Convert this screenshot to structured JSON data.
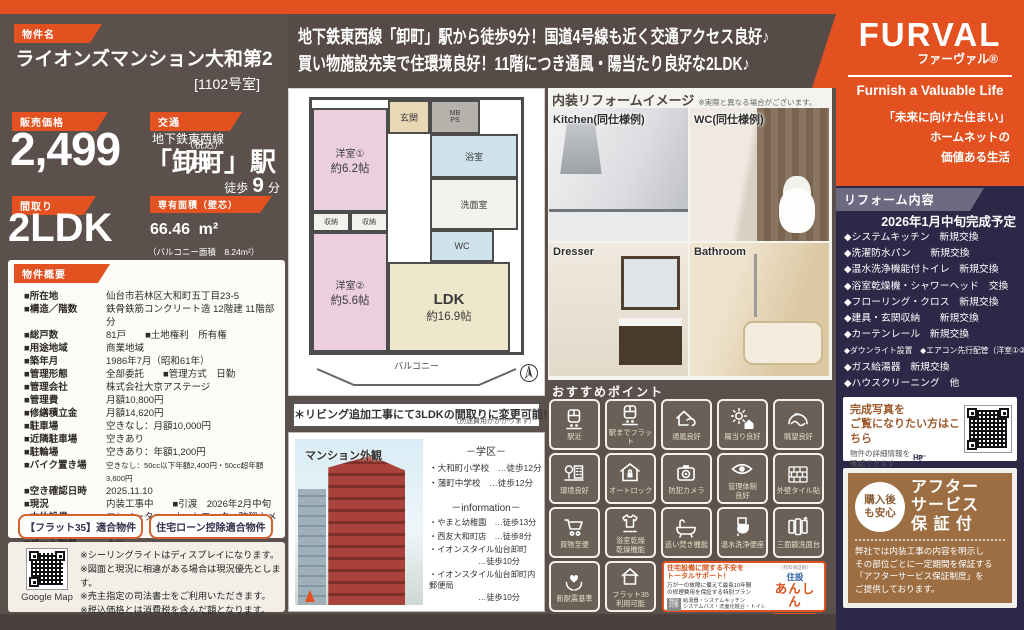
{
  "header": {
    "property_label": "物件名",
    "property_name": "ライオンズマンション大和第2",
    "room_no": "[1102号室]",
    "catch_line1": "地下鉄東西線「卸町」駅から徒歩9分！国道4号線も近く交通アクセス良好♪",
    "catch_line2": "買い物施設充実で住環境良好！11階につき通風・陽当たり良好な2LDK♪"
  },
  "brand": {
    "logo": "FURVAL",
    "logo_kana": "ファーヴァル®",
    "tagline": "Furnish a Valuable Life",
    "slogan": "「未来に向けた住まい」\nホームネットの\n価値ある生活"
  },
  "summary": {
    "price_label": "販売価格",
    "price_value": "2,499",
    "price_tax": "（税込）",
    "price_unit": "万円",
    "access_label": "交通",
    "access_line": "地下鉄東西線",
    "access_station": "「卸町」駅",
    "walk_label": "徒歩",
    "walk_min": "9",
    "walk_unit": "分",
    "layout_label": "間取り",
    "layout_value": "2LDK",
    "area_label": "専有面積（壁芯）",
    "area_value": "66.46",
    "area_unit": "m²",
    "area_note": "（バルコニー面積　8.24m²）"
  },
  "overview": {
    "title": "物件概要",
    "rows": [
      {
        "label": "■所在地",
        "value": "仙台市若林区大和町五丁目23-5"
      },
      {
        "label": "■構造／階数",
        "value": "鉄骨鉄筋コンクリート造 12階建 11階部分"
      },
      {
        "label": "■総戸数",
        "value": "81戸　　■土地権利　所有権"
      },
      {
        "label": "■用途地域",
        "value": "商業地域"
      },
      {
        "label": "■築年月",
        "value": "1986年7月（昭和61年）"
      },
      {
        "label": "■管理形態",
        "value": "全部委託　　■管理方式　日勤"
      },
      {
        "label": "■管理会社",
        "value": "株式会社大京アステージ"
      },
      {
        "label": "■管理費",
        "value": "月額10,800円"
      },
      {
        "label": "■修繕積立金",
        "value": "月額14,620円"
      },
      {
        "label": "■駐車場",
        "value": "空きなし：月額10,000円"
      },
      {
        "label": "■近隣駐車場",
        "value": "空きあり"
      },
      {
        "label": "■駐輪場",
        "value": "空きあり：年額1,200円"
      },
      {
        "label": "■バイク置き場",
        "value": "空きなし：50cc以下年額2,400円・50cc超年額3,600円"
      },
      {
        "label": "■空き確認日時",
        "value": "2025.11.10"
      },
      {
        "label": "■現況",
        "value": "内装工事中　　■引渡　2026年2月中旬"
      },
      {
        "label": "■本体設備",
        "value": "エレベーター・オートロック・防犯カメラ"
      },
      {
        "label": "■ペット飼育",
        "value": "不可"
      }
    ],
    "badge1": "【フラット35】適合物件",
    "badge2": "住宅ローン控除適合物件"
  },
  "map_notes": {
    "qr_label": "Google Map",
    "lines": "※シーリングライトはディスプレイになります。\n※図面と現況に相違がある場合は現況優先とします。\n※売主指定の司法書士をご利用いただきます。\n※税込価格とは消費税を含んだ額となります。"
  },
  "floorplan": {
    "genkan": "玄関",
    "mbps": "MB\nPS",
    "bath": "浴室",
    "wash": "洗面室",
    "wc": "WC",
    "r1": "洋室①",
    "r1_size": "約6.2帖",
    "r2": "洋室②",
    "r2_size": "約5.6帖",
    "closet": "収納",
    "ldk": "LDK",
    "ldk_size": "約16.9帖",
    "balcony": "バルコニー",
    "note_main": "＊リビング追加工事にて3LDKの間取りに変更可能！",
    "note_sub": "（別途費用がかかります）"
  },
  "exterior": {
    "title": "マンション外観",
    "school_header": "－学区－",
    "school1": "・大和町小学校　…徒歩12分",
    "school2": "・蒲町中学校　…徒歩12分",
    "info_header": "－information－",
    "info1": "・やまと幼稚園　…徒歩13分",
    "info2": "・西友大和町店　…徒歩8分",
    "info3": "・イオンスタイル仙台卸町\n　　　　　　…徒歩10分",
    "info4": "・イオンスタイル仙台卸町内郵便局\n　　　　　　…徒歩10分"
  },
  "interior": {
    "title": "内装リフォームイメージ",
    "disclaimer": "※実際と異なる場合がございます。",
    "photos": [
      {
        "label": "Kitchen(同仕様例)"
      },
      {
        "label": "WC(同仕様例)"
      },
      {
        "label": "Dresser"
      },
      {
        "label": "Bathroom"
      }
    ]
  },
  "reform": {
    "title": "リフォーム内容",
    "completion": "2026年1月中旬完成予定",
    "items": [
      "◆システムキッチン　新規交換",
      "◆洗濯防水パン　　新規交換",
      "◆温水洗浄機能付トイレ　新規交換",
      "◆浴室乾燥機・シャワーヘッド　交換",
      "◆フローリング・クロス　新規交換",
      "◆建具・玄関収納　　新規交換",
      "◆カーテンレール　新規交換",
      "◆ダウンライト設置　◆エアコン先行配管（洋室①②）",
      "◆ガス給湯器　新規交換",
      "◆ハウスクリーニング　他"
    ]
  },
  "photo_qr": {
    "line1": "完成写真を",
    "line2": "ご覧になりたい方はこちら",
    "sub": "物件の詳細情報を\n確認できます",
    "hand_label": "HP"
  },
  "after_service": {
    "circle": "購入後\nも安心",
    "title": "アフター\nサービス\n保 証 付",
    "body": "弊社では内装工事の内容を明示し\nその部位ごとに一定期間を保証する\n「アフターサービス保証制度」を\nご提供しております。"
  },
  "points": {
    "title": "おすすめポイント",
    "tiles": [
      {
        "label": "駅近"
      },
      {
        "label": "駅までフラット"
      },
      {
        "label": "通風良好"
      },
      {
        "label": "陽当り良好"
      },
      {
        "label": "眺望良好"
      },
      {
        "label": "環境良好"
      },
      {
        "label": "オートロック"
      },
      {
        "label": "防犯カメラ"
      },
      {
        "label": "管理体制\n良好"
      },
      {
        "label": "外壁タイル貼"
      },
      {
        "label": "買物至便"
      },
      {
        "label": "浴室乾燥\n乾燥機能"
      },
      {
        "label": "追い焚き機能"
      },
      {
        "label": "温水洗浄便座"
      },
      {
        "label": "三面鏡洗面台"
      },
      {
        "label": "新耐震基準"
      },
      {
        "label": "フラット35\n利用可能"
      }
    ],
    "support": {
      "heading": "住宅設備に関する不安を\nトータルサポート！",
      "body": "万が一の故障に備えて最長10年間\nの修理費用を保証する特別プラン",
      "target_label": "保証\n対象",
      "target_text": "給湯器・システムキッチン\nシステムバス・洗面化粧台・トイレ",
      "logo1": "住設",
      "logo2": "あんしん",
      "logo3": "サポート",
      "note": "（有料保証制）"
    }
  },
  "colors": {
    "accent_orange": "#e2511f",
    "base_taupe": "#5b504b",
    "navy": "#2b2947",
    "brown": "#9c6e42"
  }
}
